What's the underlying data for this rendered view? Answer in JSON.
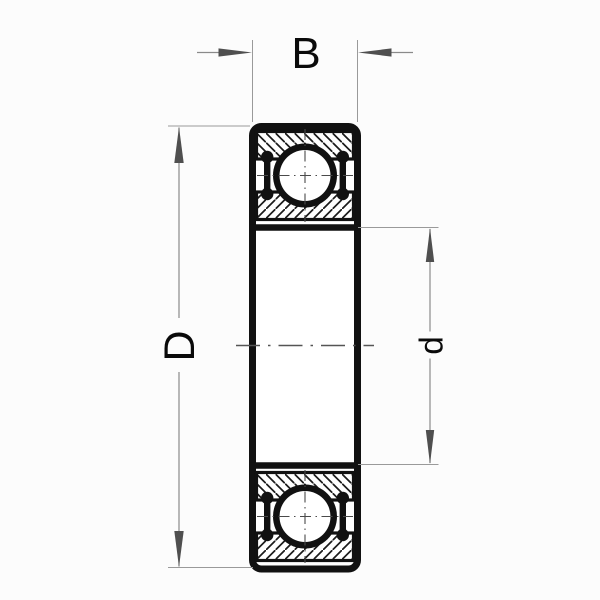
{
  "diagram": {
    "type": "deep-groove-ball-bearing-cross-section",
    "labels": {
      "width": "B",
      "outer_diameter": "D",
      "bore_diameter": "d"
    },
    "colors": {
      "ink": "#111111",
      "extension_line": "#9a9a9a",
      "arrow_fill": "#4f4f4f",
      "centerline": "#555555",
      "background": "#fcfcfc"
    }
  }
}
